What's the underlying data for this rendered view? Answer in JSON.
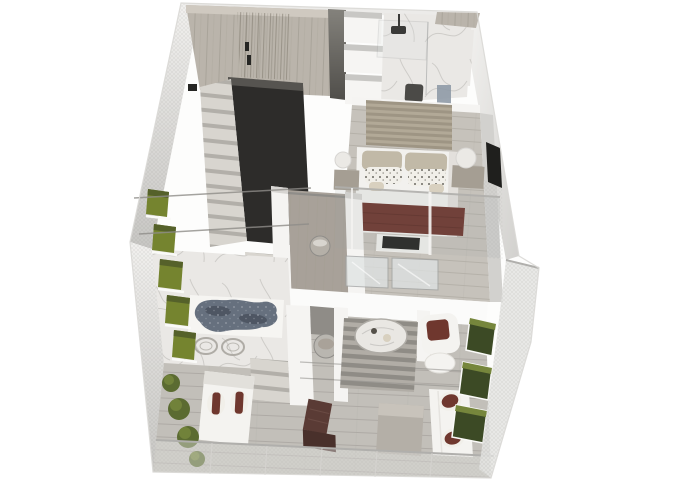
{
  "scene": {
    "type": "isometric-3d-floorplan-render",
    "description": "Bird's-eye 3D rendering of a two-level loft apartment with mesh balcony walls, white background",
    "rooms": [
      "wardrobe-closet",
      "bathroom",
      "bedroom",
      "stairwell",
      "corridor-closet",
      "terrace",
      "living-area",
      "wood-deck"
    ],
    "objects": [
      "staircase",
      "double-bed",
      "maroon-throw-blanket",
      "patterned-pillows",
      "bedside-lamps",
      "tv-console",
      "wall-tv",
      "shower",
      "vanity-counter",
      "ornate-blue-rug",
      "wire-frame-chairs",
      "striped-rug",
      "round-marble-table",
      "armchair-maroon-cushion",
      "white-sofa-maroon-pillows",
      "chaise-lounger",
      "brown-deck-chair",
      "low-wood-table",
      "round-stone-tub",
      "wicker-basket",
      "green-wall-planters",
      "green-planter-boxes",
      "shrubs",
      "glass-mesh-railings"
    ]
  },
  "colors": {
    "background": "#ffffff",
    "shell": "#fdfdfc",
    "outline": "#d9d8d5",
    "back_band": "#ecebe9",
    "wall_white": "#f5f4f2",
    "wall_top_edge": "#d7d5d2",
    "left_wall_light": "#f1f0ee",
    "left_wall_dark": "#c7c6c3",
    "right_wall_light": "#f4f3f1",
    "right_wall_dark": "#d2d1ce",
    "mesh_line": "#8a8a88",
    "railing_glass": "#e4e4e2",
    "railing_rail": "#b0afac",
    "wood_base": "#bab4ab",
    "wood_line": "#a39d93",
    "wood_top_strip": "#cfc9c0",
    "clothes_dark": "#8d877c",
    "divider_top": "#84827c",
    "divider_bottom": "#504e4a",
    "handle": "#262624",
    "cabinet": "#f6f5f3",
    "cabinet_top": "#c8c7c4",
    "marble_base": "#eae8e5",
    "marble_vein": "#b6b4b0",
    "glass_line": "#9fa1a1",
    "glass_fill": "#dfe3e3",
    "fixture": "#3a3a38",
    "door_slot": "#232322",
    "stool": "#4b4a47",
    "counter_wood": "#a8a19a",
    "tile_blue": "#8f9aa6",
    "plank_base": "#c6c2bb",
    "plank_line": "#b0aca5",
    "slat_a": "#b2a997",
    "slat_b": "#9e9584",
    "bed_white": "#f2f1ee",
    "bed_shade": "#dedcd7",
    "pillow_back": "#c1b9a7",
    "pillow_front": "#f1efe9",
    "pillow_dot": "#55514a",
    "bolster": "#d8d0bf",
    "blanket": "#6b3129",
    "blanket_fold": "#58271f",
    "tv": "#1f1f1d",
    "nightstand": "#a59e93",
    "lamp": "#ebe9e5",
    "charcoal": "#2d2c2a",
    "charcoal_top": "#565450",
    "step_face": "#d8d5cf",
    "step_shadow": "#b2afa9",
    "corridor_wood": "#a8a199",
    "basket": "#b5b0a8",
    "rail_metal": "#8f8d89",
    "slab": "#fbfbfa",
    "niche": "#8f8c87",
    "tub": "#b9b6b0",
    "deck_base": "#c2bfb9",
    "deck_line": "#aaa7a1",
    "rug_mat": "#f6f5f2",
    "rug_blue": "#66707e",
    "rug_blue_dark": "#49505c",
    "rug_speck": "#9aa1ac",
    "wire_chair": "#afaca6",
    "stripe_a": "#b1ada6",
    "stripe_b": "#8f8c86",
    "table_marble": "#e9e7e3",
    "sofa": "#f4f3f0",
    "sofa_shade": "#e2e0db",
    "maroon": "#6f372e",
    "planter_green": "#75842f",
    "planter_top": "#55612a",
    "planter_right": "#3c4a25",
    "shelf_white": "#fafaf8",
    "shrub": "#5b6b31",
    "shrub_light": "#76863c",
    "chair_brown": "#5a3b35",
    "chair_brown_dark": "#49302b",
    "deck_table": "#b4afa7",
    "deck_table_top": "#c8c3bb",
    "shadow": "#2a2a28"
  }
}
